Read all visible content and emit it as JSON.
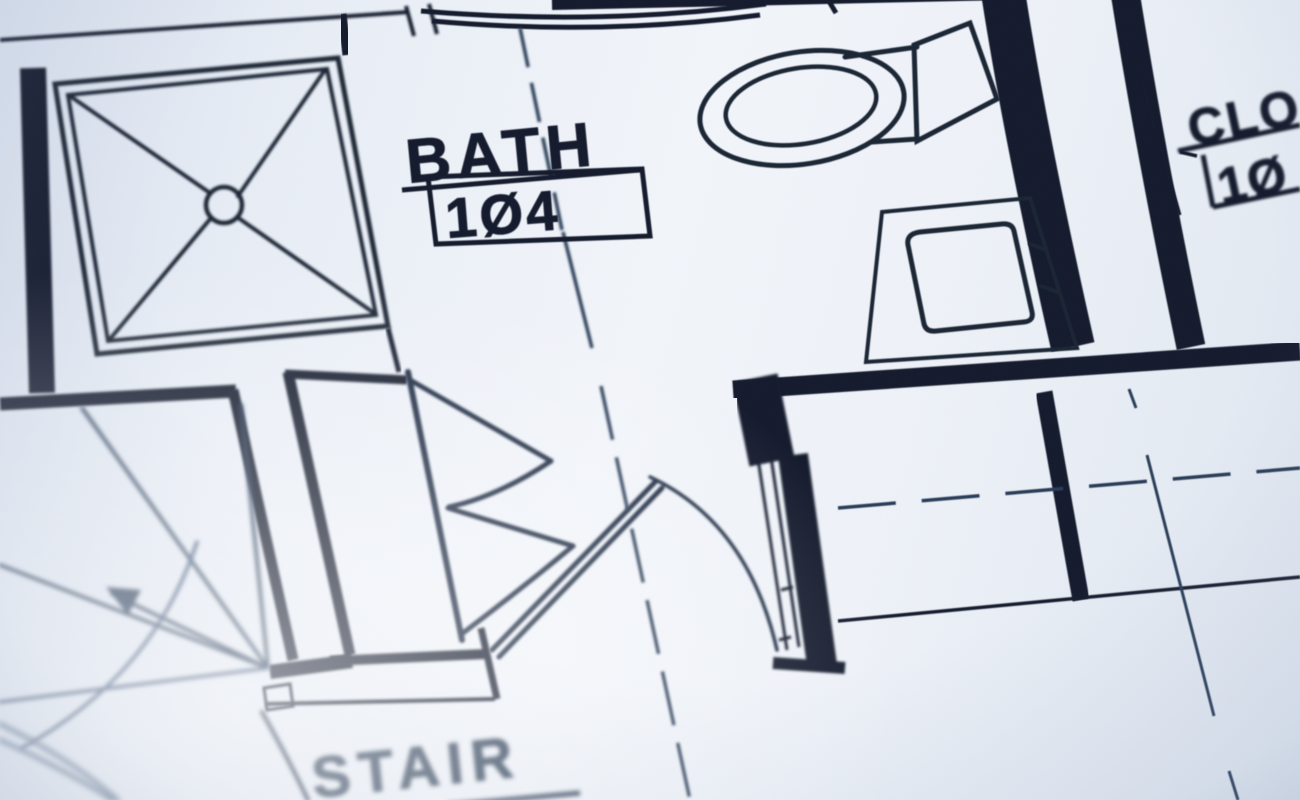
{
  "scene": {
    "kind": "blueprint-floor-plan-photo",
    "rooms": {
      "bath": {
        "name": "BATH",
        "number": "1Ø4"
      },
      "closet": {
        "name": "CLO",
        "number": "1Ø"
      },
      "stair": {
        "name": "STAIR"
      }
    },
    "fixtures": {
      "shower": "shower-pan-with-center-drain",
      "toilet": "toilet-with-tank",
      "sink": "vanity-countertop-sink"
    },
    "colors": {
      "paper_light": "#f2f5fa",
      "paper_shade": "#dde4ef",
      "ink_dark": "#161f2e",
      "ink_medium": "#2c3e58",
      "ink_soft": "#44587a",
      "ink_faint": "#5a6e8a"
    }
  }
}
